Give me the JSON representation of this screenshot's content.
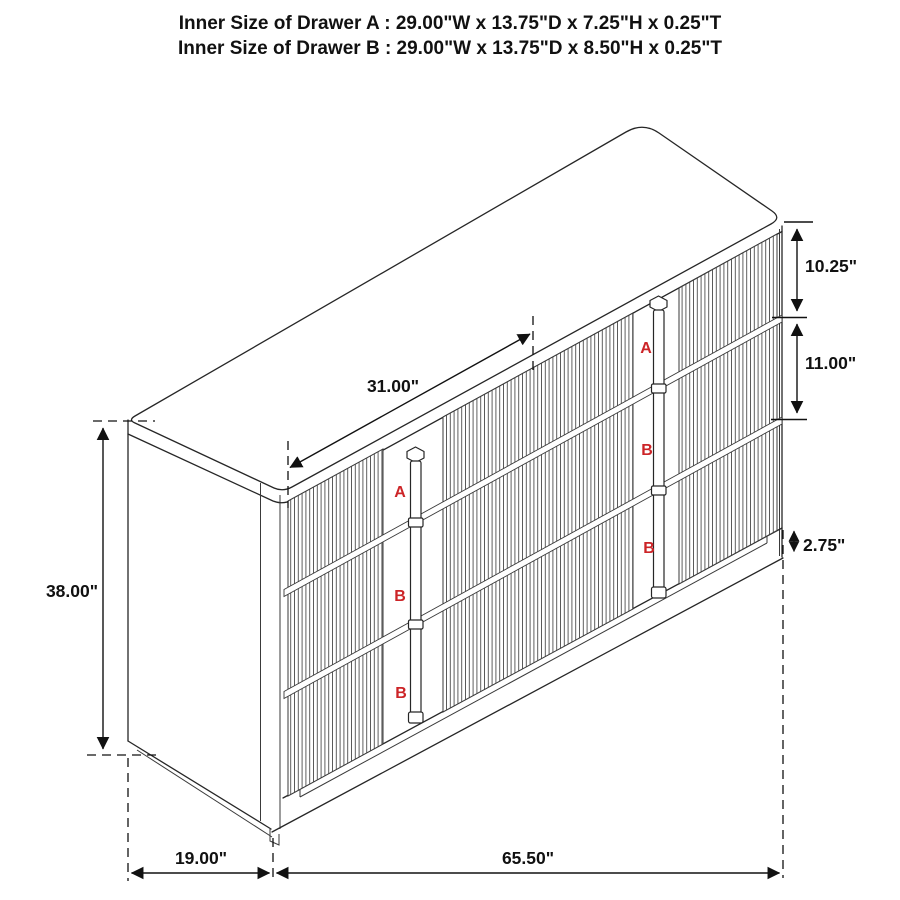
{
  "title": {
    "line1": "Inner Size of Drawer A : 29.00\"W x 13.75\"D x 7.25\"H x 0.25\"T",
    "line2": "Inner Size of Drawer B : 29.00\"W x 13.75\"D x 8.50\"H x 0.25\"T"
  },
  "diagram": {
    "subject": "3-bay fluted dresser dimension drawing",
    "dim_labels": {
      "overall_height": "38.00\"",
      "center_section_width": "31.00\"",
      "top_drawer_front_height": "10.25\"",
      "middle_drawer_front_height": "11.00\"",
      "base_height": "2.75\"",
      "overall_depth": "19.00\"",
      "overall_width": "65.50\""
    },
    "drawer_labels": {
      "left_column": [
        "A",
        "B",
        "B"
      ],
      "right_column": [
        "A",
        "B",
        "B"
      ]
    },
    "colors": {
      "drawer_label_red": "#cc2427",
      "line_color": "#262626",
      "dimension_color": "#111111",
      "background": "#ffffff"
    }
  }
}
